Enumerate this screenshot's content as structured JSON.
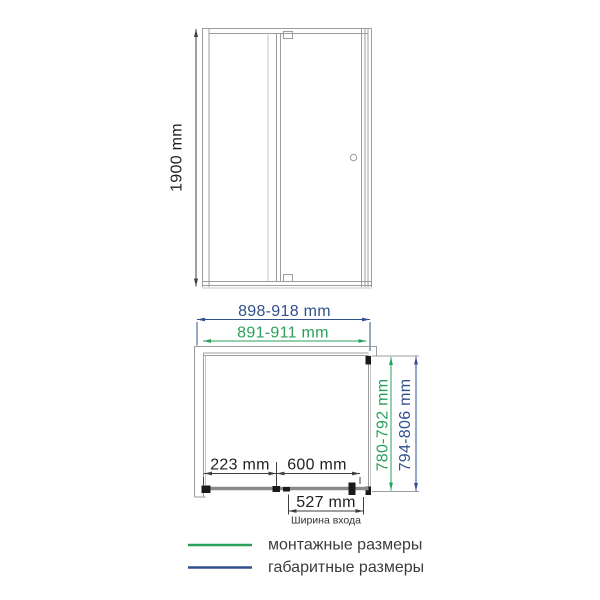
{
  "colors": {
    "green": "#2aa05c",
    "navy": "#31508e",
    "gray": "#9c9c9c",
    "dark": "#3f3f3f",
    "black": "#1a1a1a"
  },
  "front_view": {
    "height_label": "1900 mm"
  },
  "plan_view": {
    "overall_width_label": "898-918 mm",
    "mounting_width_label": "891-911 mm",
    "mounting_depth_label": "780-792 mm",
    "overall_depth_label": "794-806 mm",
    "fixed_panel_label": "223 mm",
    "door_panel_label": "600 mm",
    "entry_width_label": "527 mm",
    "entry_width_caption": "Ширина входа"
  },
  "legend": {
    "items": [
      {
        "label": "монтажные размеры",
        "color_key": "green"
      },
      {
        "label": "габаритные размеры",
        "color_key": "navy"
      }
    ]
  }
}
